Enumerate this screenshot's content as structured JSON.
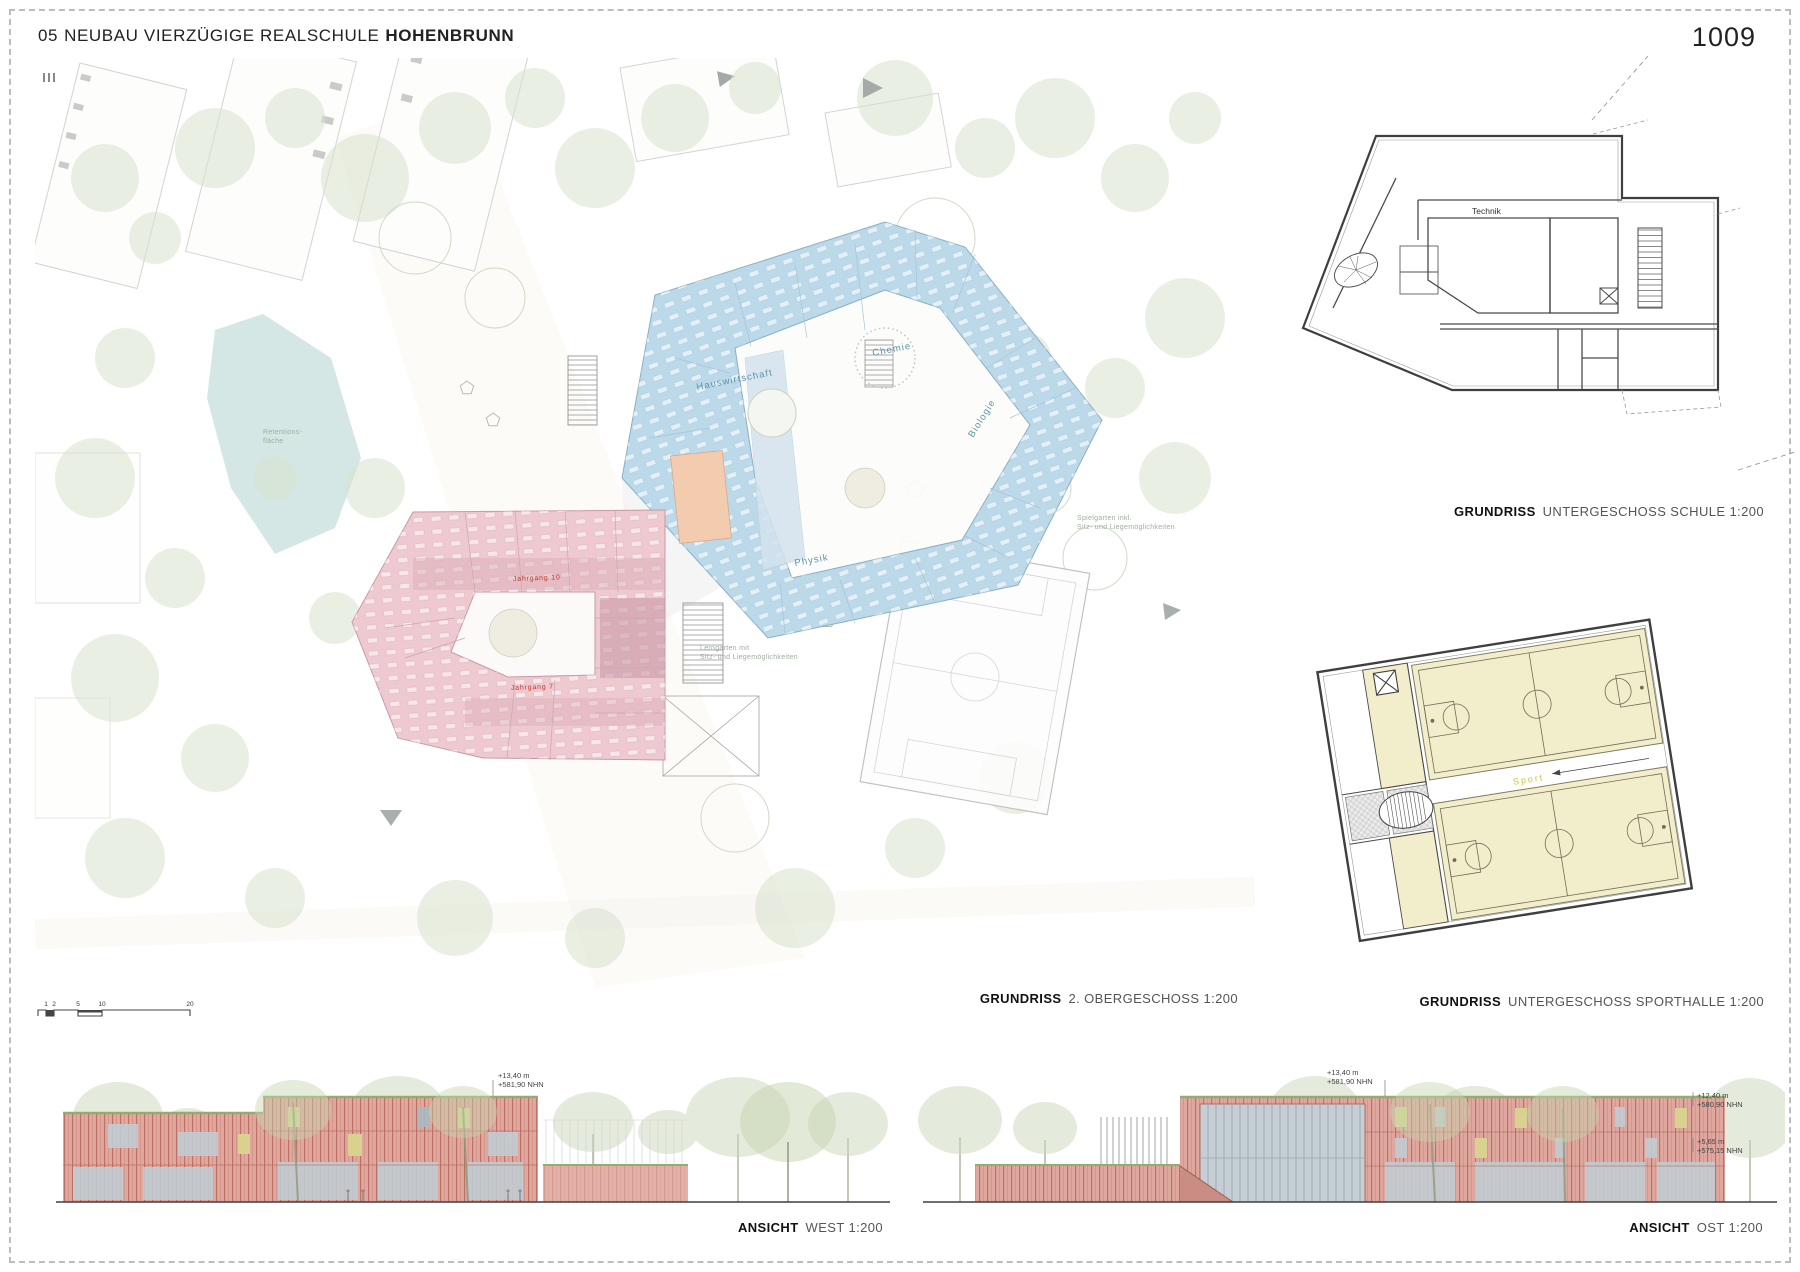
{
  "page": {
    "title_num": "05",
    "title_main": "NEUBAU VIERZÜGIGE REALSCHULE",
    "title_city": "HOHENBRUNN",
    "sheet_number": "1009"
  },
  "captions": {
    "main_bold": "GRUNDRISS",
    "main_rest": "2. OBERGESCHOSS 1:200",
    "schule_bold": "GRUNDRISS",
    "schule_rest": "UNTERGESCHOSS SCHULE 1:200",
    "sport_bold": "GRUNDRISS",
    "sport_rest": "UNTERGESCHOSS SPORTHALLE 1:200",
    "west_bold": "ANSICHT",
    "west_rest": "WEST 1:200",
    "ost_bold": "ANSICHT",
    "ost_rest": "OST 1:200"
  },
  "main_plan": {
    "wing_labels": {
      "hauswirtschaft": "Hauswirtschaft",
      "chemie": "Chemie",
      "biologie": "Biologie",
      "physik": "Physik"
    },
    "jahrgang_top": "Jahrgang 10",
    "jahrgang_bottom": "Jahrgang 7",
    "site_labels": {
      "pond_1": "Retentions-",
      "pond_2": "fläche",
      "garden_right_1": "Spielgarten inkl.",
      "garden_right_2": "Sitz- und Liegemöglichkeiten",
      "garden_mid_1": "Lerngarten mit",
      "garden_mid_2": "Sitz- und Liegemöglichkeiten"
    },
    "scale_ticks": [
      "1",
      "2",
      "5",
      "10",
      "20"
    ]
  },
  "ug_schule": {
    "room_label": "Technik"
  },
  "ug_sport": {
    "hall_label": "Sport"
  },
  "elevations": {
    "west": {
      "level": "+13,40 m",
      "nhn": "+581,90 NHN"
    },
    "ost": {
      "level1": "+13,40 m",
      "nhn1": "+581,90 NHN",
      "level2": "+12,40 m",
      "nhn2": "+580,90 NHN",
      "level3": "+5,65 m",
      "nhn3": "+575,15 NHN"
    }
  },
  "colors": {
    "wing_blue": "#bcd9ea",
    "wing_pink": "#eec9d0",
    "room_orange": "#f3ccb0",
    "court_beige": "#f2edcb",
    "facade_red": "#dfa29a",
    "label_blue": "#5b93ad",
    "label_red": "#c0392b",
    "sport_yellow": "#cfc23a"
  }
}
